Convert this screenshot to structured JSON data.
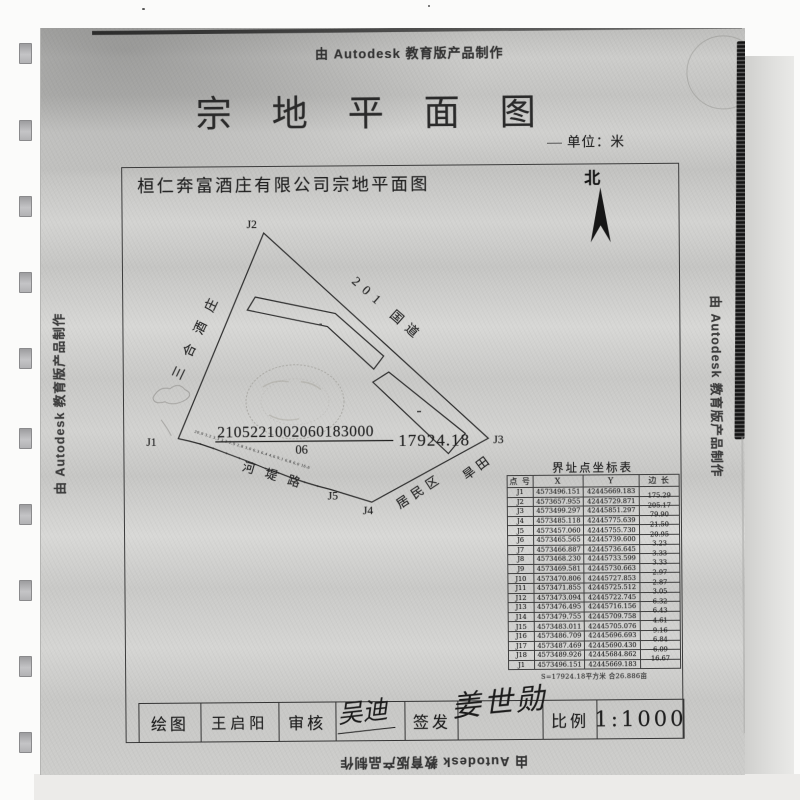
{
  "scan": {
    "watermark_top": "由 Autodesk 教育版产品制作",
    "watermark_left": "由 Autodesk 教育版产品制作",
    "watermark_right": "由 Autodesk 教育版产品制作",
    "watermark_bottom": "由 Autodesk 教育版产品制作"
  },
  "header": {
    "title": "宗地平面图",
    "unit_label": "单位：米"
  },
  "drawing": {
    "subtitle": "桓仁奔富酒庄有限公司宗地平面图",
    "north_label": "北",
    "parcel_number": "2105221002060183000",
    "parcel_sub_number": "06",
    "area": "17924.18",
    "point_labels": {
      "j1": "J1",
      "j2": "J2",
      "j3": "J3",
      "j4": "J4",
      "j5": "J5"
    },
    "edge_labels": {
      "west": "三合酒庄",
      "northeast": "201 国道",
      "southwest": "河堤路",
      "southeast": "居民区",
      "east": "旱田"
    },
    "tick_numbers": "20.9 3.2 3.3 3.3 2.9 2.8 3.0 6.3 6.4 4.6 9.1 6.8 6.0 16.6"
  },
  "coordinate_table": {
    "title": "界址点坐标表",
    "headers": [
      "点 号",
      "X",
      "Y",
      "边 长"
    ],
    "rows": [
      [
        "J1",
        "4573496.151",
        "42445669.183",
        "175.29"
      ],
      [
        "J2",
        "4573657.955",
        "42445729.871",
        "205.17"
      ],
      [
        "J3",
        "4573499.297",
        "42445851.297",
        "79.90"
      ],
      [
        "J4",
        "4573485.118",
        "42445775.639",
        "21.50"
      ],
      [
        "J5",
        "4573457.060",
        "42445755.730",
        "20.95"
      ],
      [
        "J6",
        "4573465.565",
        "42445739.600",
        "3.23"
      ],
      [
        "J7",
        "4573466.887",
        "42445736.645",
        "3.33"
      ],
      [
        "J8",
        "4573468.230",
        "42445733.599",
        "3.33"
      ],
      [
        "J9",
        "4573469.581",
        "42445730.663",
        "2.97"
      ],
      [
        "J10",
        "4573470.806",
        "42445727.853",
        "2.87"
      ],
      [
        "J11",
        "4573471.855",
        "42445725.512",
        "3.05"
      ],
      [
        "J12",
        "4573473.094",
        "42445722.745",
        "6.32"
      ],
      [
        "J13",
        "4573476.495",
        "42445716.156",
        "6.43"
      ],
      [
        "J14",
        "4573479.755",
        "42445709.758",
        "4.61"
      ],
      [
        "J15",
        "4573483.011",
        "42445705.076",
        "9.16"
      ],
      [
        "J16",
        "4573486.709",
        "42445696.693",
        "6.84"
      ],
      [
        "J17",
        "4573487.469",
        "42445690.430",
        "6.09"
      ],
      [
        "J18",
        "4573489.926",
        "42445684.862",
        "16.67"
      ],
      [
        "J1",
        "4573496.151",
        "42445669.183",
        ""
      ]
    ],
    "footer": "S=17924.18平方米 合26.886亩"
  },
  "title_block": {
    "draw_label": "绘图",
    "draftsman": "王启阳",
    "review_label": "审核",
    "reviewer_signature": "吴迪",
    "issue_label": "签发",
    "issuer_signature": "姜世勋",
    "scale_label": "比例",
    "scale_value": "1:1000"
  }
}
